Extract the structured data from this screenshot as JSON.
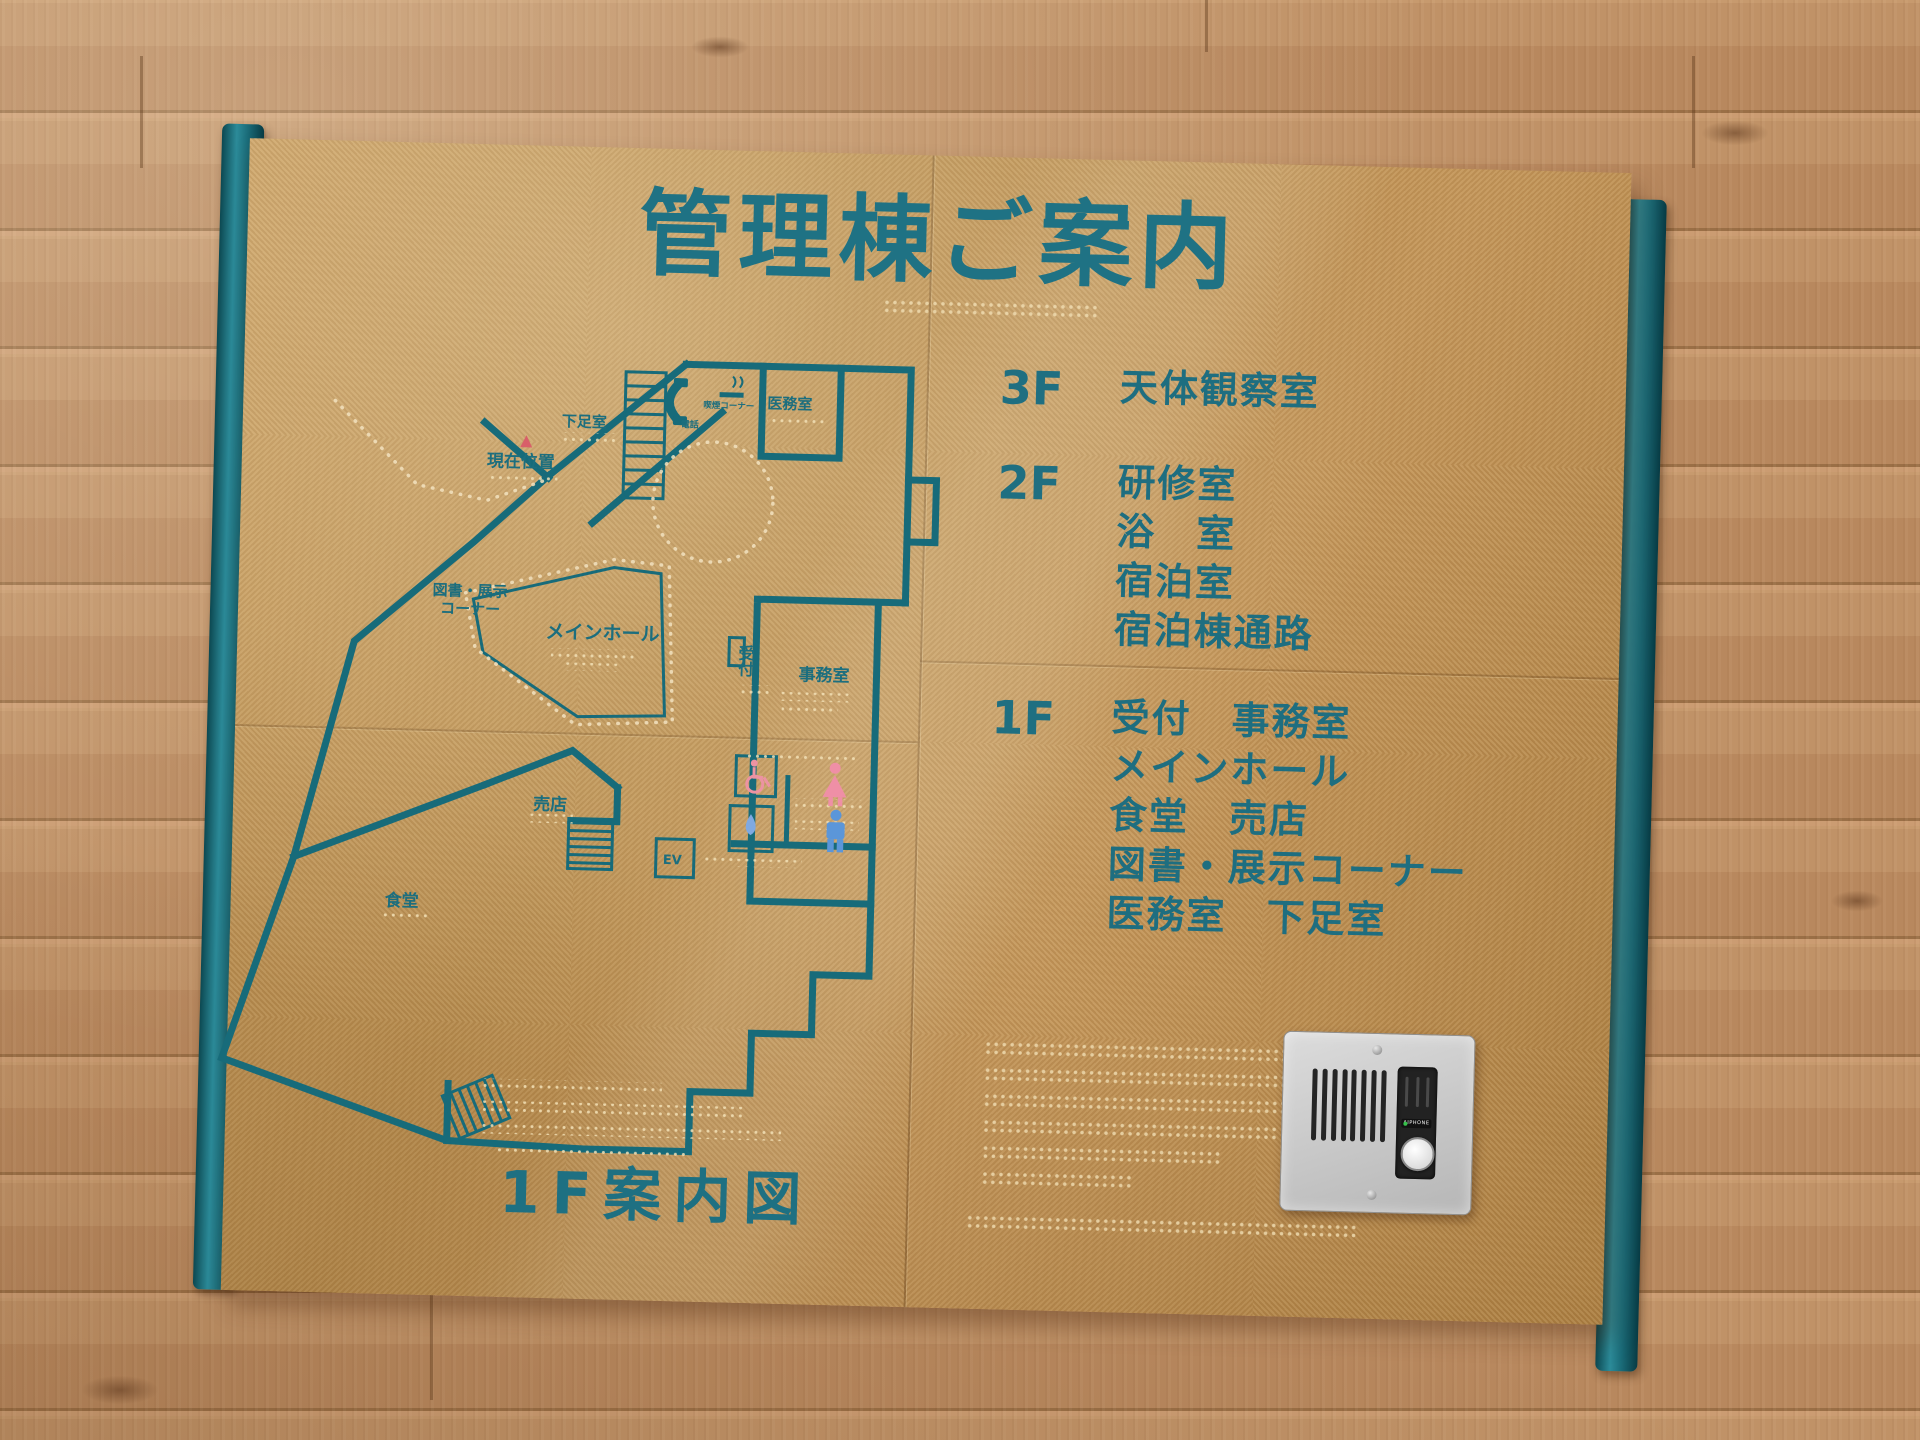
{
  "sign": {
    "title": "管理棟ご案内",
    "caption": "1F案内図",
    "directory": [
      {
        "floor": "3F",
        "rooms": [
          "天体観察室"
        ]
      },
      {
        "floor": "2F",
        "rooms": [
          "研修室",
          "浴　室",
          "宿泊室",
          "宿泊棟通路"
        ]
      },
      {
        "floor": "1F",
        "rooms": [
          "受付　事務室",
          "メインホール",
          "食堂　売店",
          "図書・展示コーナー",
          "医務室　下足室"
        ]
      }
    ],
    "plan": {
      "labels": {
        "shoe_room": "下足室",
        "medical_room": "医務室",
        "phone": "電話",
        "smoking_corner": "喫煙コーナー",
        "current_location": "現在位置",
        "library_line1": "図書・展示",
        "library_line2": "コーナー",
        "main_hall": "メインホール",
        "reception": "受付",
        "office": "事務室",
        "shop": "売店",
        "dining": "食堂",
        "elevator": "EV"
      }
    },
    "intercom": {
      "brand": "AIPHONE"
    },
    "colors": {
      "board_gold": "#b98f52",
      "line_teal": "#176b7a",
      "text_teal": "#1f7183",
      "rail_teal": "#156671",
      "wall_wood": "#bd8f66",
      "current_location_red": "#d85f69",
      "female_pink": "#ef8fa6",
      "male_blue": "#5b96d9"
    }
  }
}
